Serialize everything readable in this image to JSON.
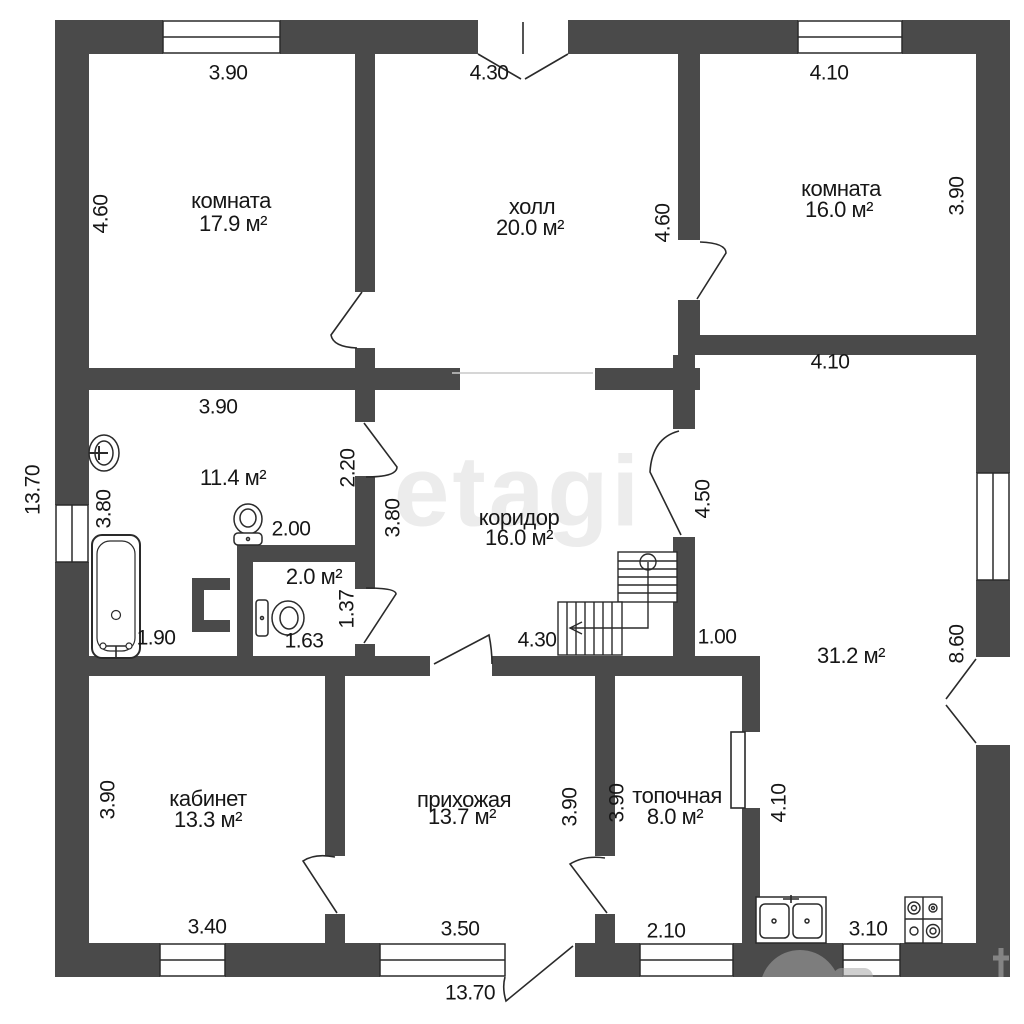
{
  "rooms": {
    "bedroom1": {
      "name": "комната",
      "area": "17.9 м²"
    },
    "hall": {
      "name": "холл",
      "area": "20.0 м²"
    },
    "bedroom2": {
      "name": "комната",
      "area": "16.0 м²"
    },
    "bathroom": {
      "area": "11.4 м²"
    },
    "wc": {
      "area": "2.0 м²"
    },
    "corridor": {
      "name": "коридор",
      "area": "16.0 м²"
    },
    "living": {
      "area": "31.2 м²"
    },
    "office": {
      "name": "кабинет",
      "area": "13.3 м²"
    },
    "entry": {
      "name": "прихожая",
      "area": "13.7 м²"
    },
    "boiler": {
      "name": "топочная",
      "area": "8.0 м²"
    }
  },
  "dims": {
    "outer_left": "13.70",
    "outer_bottom": "13.70",
    "bedroom1_top": "3.90",
    "bedroom1_left": "4.60",
    "hall_top": "4.30",
    "hall_right": "4.60",
    "bedroom2_top": "4.10",
    "bedroom2_right": "3.90",
    "bedroom2_bottom": "4.10",
    "bath_top": "3.90",
    "bath_left": "3.80",
    "bath_door": "2.20",
    "bath_toilet": "2.00",
    "bath_tub": "1.90",
    "wc_width": "1.63",
    "wc_height": "1.37",
    "corridor_left": "3.80",
    "corridor_bottom": "4.30",
    "living_door": "4.50",
    "living_notch": "1.00",
    "living_right": "8.60",
    "office_left": "3.90",
    "office_bottom": "3.40",
    "entry_right": "3.90",
    "entry_bottom": "3.50",
    "boiler_left": "3.90",
    "boiler_right": "4.10",
    "boiler_bottom": "2.10",
    "kitchen_bottom": "3.10"
  },
  "watermarks": {
    "center": "etagi"
  },
  "colors": {
    "wall": "#4a4a4a",
    "line": "#2a2a2a",
    "text": "#161616",
    "watermark": "#ececec"
  }
}
